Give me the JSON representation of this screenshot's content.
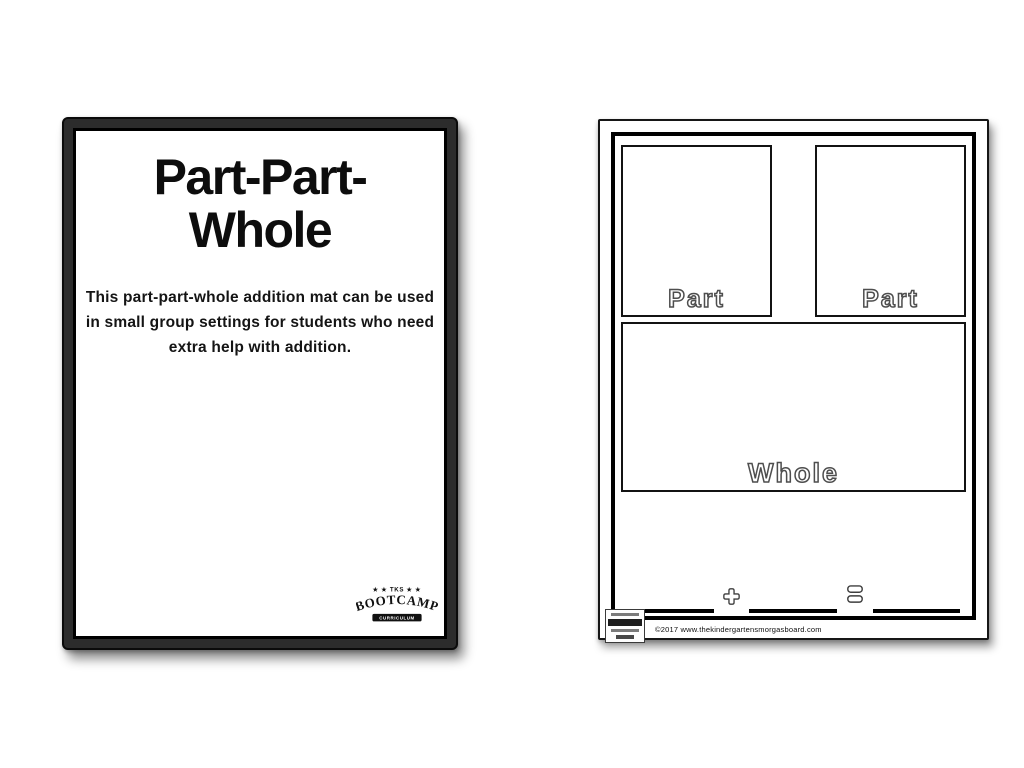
{
  "colors": {
    "background": "#ffffff",
    "poster_frame": "#2c2c2c",
    "ink": "#000000",
    "outline_letter_stroke": "#4e4e4e"
  },
  "left_card": {
    "title_lines": [
      "Part-Part-",
      "Whole"
    ],
    "description_lines": [
      "This part-part-whole addition mat can be used",
      "in small group settings for students who need",
      "extra help with addition."
    ],
    "logo": {
      "top_line": "★ ★ TKS ★ ★",
      "name": "BOOTCAMP",
      "subtitle": "CURRICULUM"
    }
  },
  "worksheet": {
    "part_boxes": [
      {
        "label": "Part"
      },
      {
        "label": "Part"
      }
    ],
    "whole_box": {
      "label": "Whole"
    },
    "icons": {
      "plus": "plus-outline-icon",
      "equals": "equals-outline-icon"
    },
    "footer": {
      "copyright": "©2017 www.thekindergartensmorgasboard.com"
    }
  }
}
